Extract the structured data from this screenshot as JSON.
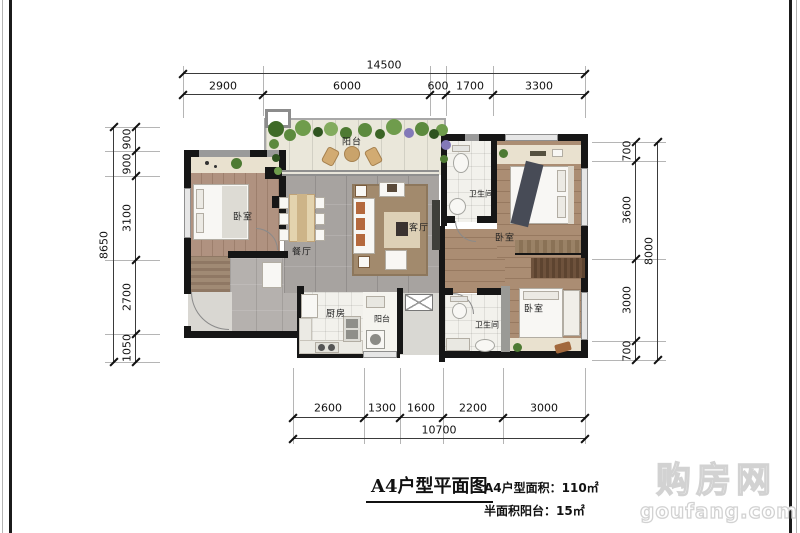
{
  "title_block": {
    "title": "A4户型平面图",
    "area_line": "A4户型面积：110㎡",
    "balcony_line": "半面积阳台：15㎡"
  },
  "watermark": {
    "name": "购房网",
    "domain": "goufang.com"
  },
  "rooms": {
    "bedroom_tl": "卧室",
    "balcony_top": "阳台",
    "dining": "餐厅",
    "living": "客厅",
    "bath_upper": "卫生间",
    "bedroom_master": "卧室",
    "kitchen": "厨房",
    "balcony_small": "阳台",
    "bath_lower": "卫生间",
    "bedroom_br": "卧室"
  },
  "dims": {
    "top": {
      "total": "14500",
      "segs": [
        "2900",
        "6000",
        "600",
        "1700",
        "3300"
      ]
    },
    "left": {
      "total": "8650",
      "segs": [
        "900",
        "900",
        "3100",
        "2700",
        "1050"
      ]
    },
    "right": {
      "total": "8000",
      "segs": [
        "700",
        "3600",
        "3000",
        "700"
      ]
    },
    "bottom": {
      "total": "10700",
      "segs": [
        "2600",
        "1300",
        "1600",
        "2200",
        "3000"
      ]
    }
  },
  "colors": {
    "wall": "#161616",
    "tile": "#a7a3a0",
    "wood": "#ab8d73",
    "plant": "#4e7a33"
  }
}
